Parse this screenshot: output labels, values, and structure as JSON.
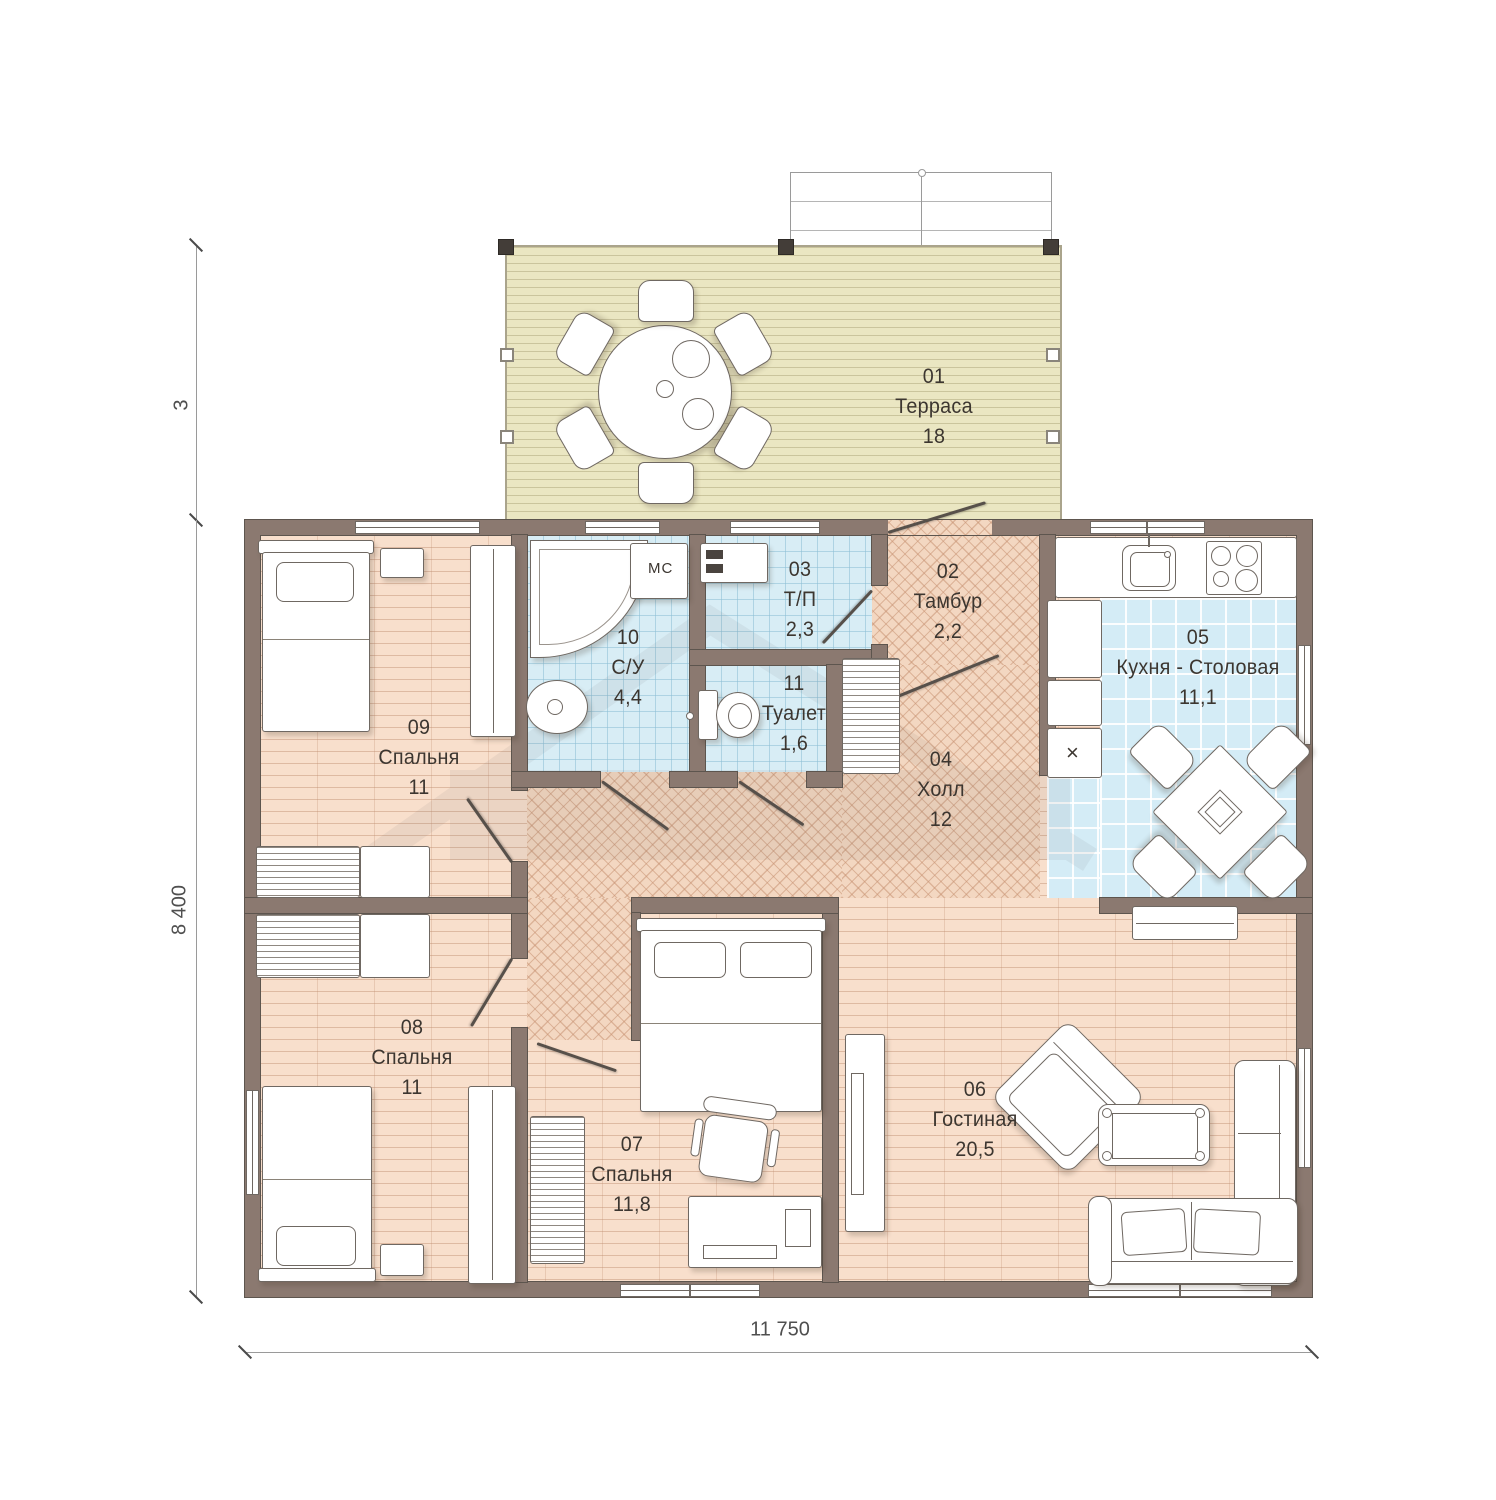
{
  "dimensions": {
    "overall_width": "11 750",
    "overall_height": "8 400",
    "terrace_depth": "3"
  },
  "rooms": {
    "r01": {
      "number": "01",
      "name": "Терраса",
      "area": "18"
    },
    "r02": {
      "number": "02",
      "name": "Тамбур",
      "area": "2,2"
    },
    "r03": {
      "number": "03",
      "name": "Т/П",
      "area": "2,3"
    },
    "r04": {
      "number": "04",
      "name": "Холл",
      "area": "12"
    },
    "r05": {
      "number": "05",
      "name": "Кухня - Столовая",
      "area": "11,1"
    },
    "r06": {
      "number": "06",
      "name": "Гостиная",
      "area": "20,5"
    },
    "r07": {
      "number": "07",
      "name": "Спальня",
      "area": "11,8"
    },
    "r08": {
      "number": "08",
      "name": "Спальня",
      "area": "11"
    },
    "r09": {
      "number": "09",
      "name": "Спальня",
      "area": "11"
    },
    "r10": {
      "number": "10",
      "name": "С/У",
      "area": "4,4"
    },
    "r11": {
      "number": "11",
      "name": "Туалет",
      "area": "1,6"
    }
  },
  "annotations": {
    "washing_machine": "МС",
    "fridge_mark": "×"
  },
  "colors": {
    "wall": "#8b7970",
    "wood_floor": "#f8dfcc",
    "herringbone_floor": "#f3d7c1",
    "tile_floor": "#d8edf5",
    "terrace_deck": "#eae6c2"
  }
}
